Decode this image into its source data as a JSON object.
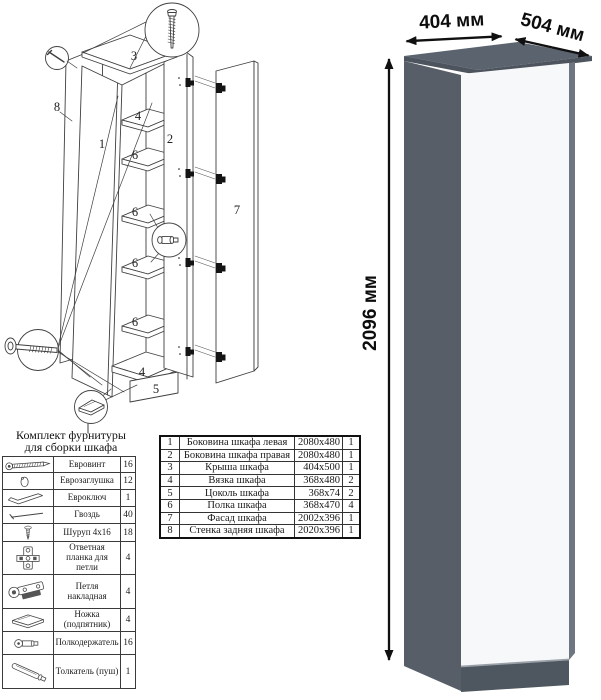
{
  "diagram": {
    "labels": {
      "left_side": "1",
      "right_side": "2",
      "top_panel": "3",
      "tie_top": "4",
      "tie_bottom": "4",
      "plinth": "5",
      "shelf_1": "6",
      "shelf_2": "6",
      "shelf_3": "6",
      "shelf_4": "6",
      "facade": "7",
      "back_panel": "8"
    }
  },
  "hardware": {
    "title_line1": "Комплект фурнитуры",
    "title_line2": "для сборки шкафа",
    "rows": [
      {
        "icon": "confirmat-screw-icon",
        "name": "Евровинт",
        "qty": "16"
      },
      {
        "icon": "cap-icon",
        "name": "Еврозаглушка",
        "qty": "12"
      },
      {
        "icon": "hex-key-icon",
        "name": "Евроключ",
        "qty": "1"
      },
      {
        "icon": "nail-icon",
        "name": "Гвоздь",
        "qty": "40"
      },
      {
        "icon": "screw-icon",
        "name": "Шуруп 4x16",
        "qty": "18"
      },
      {
        "icon": "hinge-plate-icon",
        "name": "Ответная планка для петли",
        "qty": "4"
      },
      {
        "icon": "hinge-icon",
        "name": "Петля накладная",
        "qty": "4"
      },
      {
        "icon": "foot-icon",
        "name": "Ножка (подпятник)",
        "qty": "4"
      },
      {
        "icon": "shelf-pin-icon",
        "name": "Полкодержатель",
        "qty": "16"
      },
      {
        "icon": "push-rod-icon",
        "name": "Толкатель (пуш)",
        "qty": "1"
      }
    ]
  },
  "parts": {
    "rows": [
      {
        "num": "1",
        "name": "Боковина шкафа левая",
        "size": "2080x480",
        "qty": "1"
      },
      {
        "num": "2",
        "name": "Боковина шкафа правая",
        "size": "2080x480",
        "qty": "1"
      },
      {
        "num": "3",
        "name": "Крыша шкафа",
        "size": "404x500",
        "qty": "1"
      },
      {
        "num": "4",
        "name": "Вязка шкафа",
        "size": "368x480",
        "qty": "2"
      },
      {
        "num": "5",
        "name": "Цоколь шкафа",
        "size": "368x74",
        "qty": "2"
      },
      {
        "num": "6",
        "name": "Полка шкафа",
        "size": "368x470",
        "qty": "4"
      },
      {
        "num": "7",
        "name": "Фасад шкафа",
        "size": "2002x396",
        "qty": "1"
      },
      {
        "num": "8",
        "name": "Стенка задняя шкафа",
        "size": "2020x396",
        "qty": "1"
      }
    ]
  },
  "dimensions": {
    "width": "404 мм",
    "depth": "504 мм",
    "height": "2096 мм"
  },
  "colors": {
    "body": "#575e68",
    "body_dark": "#4d545e",
    "top": "#5b636e",
    "door": "#f7f8f9",
    "plinth": "#4e565f",
    "edge": "#6e7681"
  }
}
